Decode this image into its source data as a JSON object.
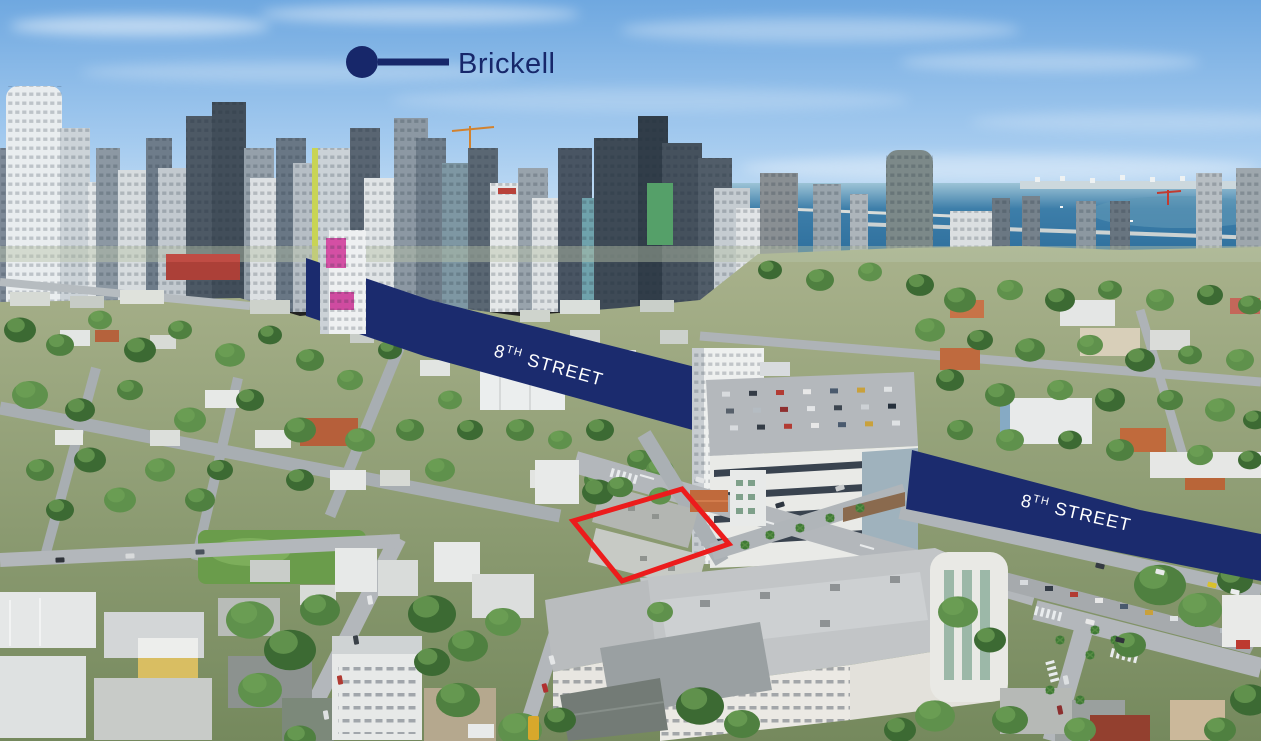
{
  "annotations": {
    "neighborhood_callout": {
      "label": "Brickell"
    },
    "street": {
      "number": "8",
      "ordinal": "TH",
      "rest": " STREET"
    }
  },
  "colors": {
    "banner_navy": "#1b2b6e",
    "callout_navy": "#17276a",
    "street_label_text": "#ffffff",
    "property_highlight_red": "#ec1c1c"
  }
}
